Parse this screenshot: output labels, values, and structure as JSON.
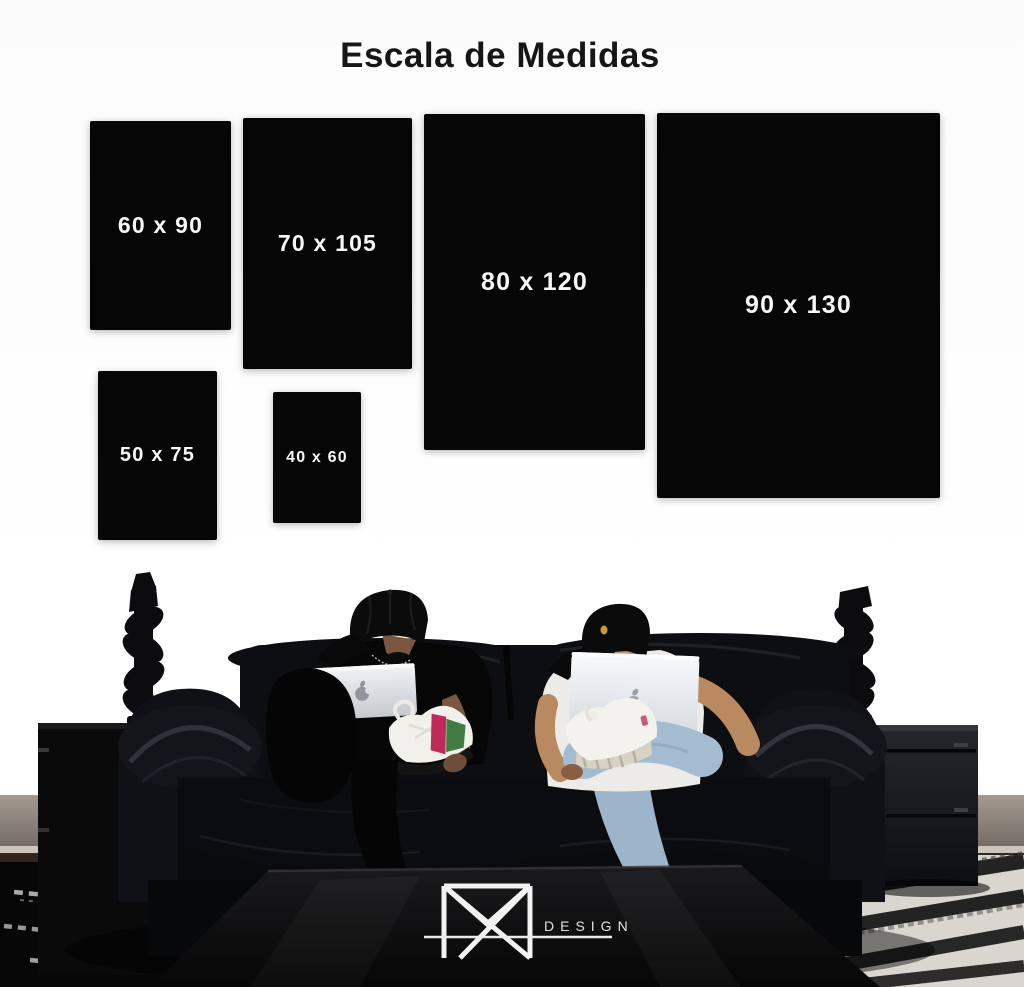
{
  "title": "Escala de Medidas",
  "sizes": [
    {
      "id": "60x90",
      "label": "60 x 90"
    },
    {
      "id": "70x105",
      "label": "70 x 105"
    },
    {
      "id": "80x120",
      "label": "80 x 120"
    },
    {
      "id": "90x130",
      "label": "90 x 130"
    },
    {
      "id": "50x75",
      "label": "50 x 75"
    },
    {
      "id": "40x60",
      "label": "40 x 60"
    }
  ],
  "brand": {
    "monogram_icon": "m-monogram-icon",
    "wordmark": "DESIGN"
  },
  "scene": {
    "apple_logo_icon": "apple-logo-icon",
    "objects": [
      "black-leather-sofa",
      "man-with-black-cap-and-black-tshirt-using-macbook",
      "man-with-black-cap-and-white-tshirt-and-jeans-using-macbook",
      "twisted-black-candlestick-left",
      "twisted-black-candlestick-right",
      "black-side-table-left",
      "black-two-drawer-side-table-right",
      "black-coffee-table-with-logo",
      "striped-shag-rugs"
    ]
  },
  "colors": {
    "background": "#ffffff",
    "canvas_black": "#060606",
    "label_text": "#f7f7f7",
    "title_text": "#161616",
    "jeans_blue": "#a3bcd2",
    "sneaker_pink": "#bf2a5a",
    "sneaker_green": "#417c42",
    "cap_badge_gold": "#c79a35",
    "baseboard_gray": "#968b83",
    "floor_brown": "#2a1f17",
    "logo_white": "#f2f2f2"
  }
}
